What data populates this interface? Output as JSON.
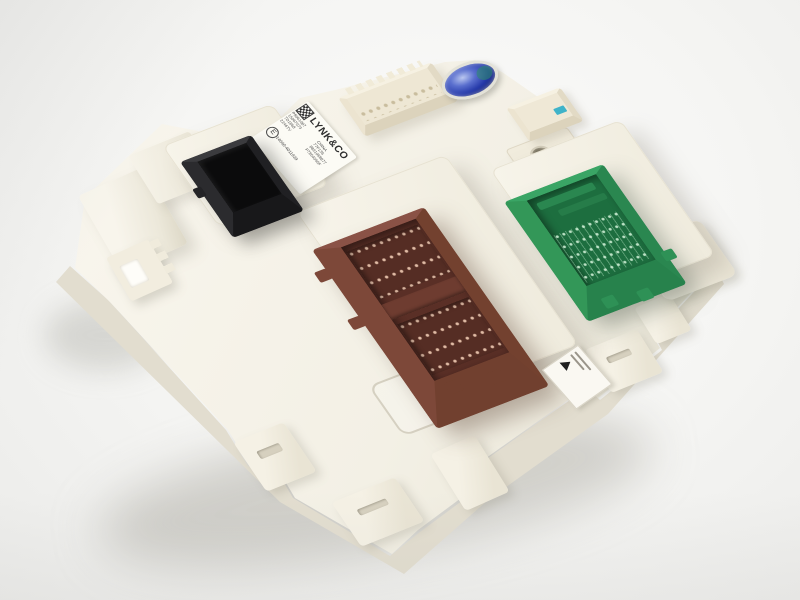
{
  "caption": "White automotive body control module photographed on a white background, with one black, one brown and one green connector socket, a blue vent seal and a LYNK&CO product label",
  "colors": {
    "background": "#f3f3f1",
    "module_body": "#f4f1e6",
    "black_connector": "#1c1c1e",
    "brown_connector": "#7a4637",
    "green_connector": "#2e9156",
    "blue_seal": "#2a3aa4",
    "label_background": "#fcfbf5"
  },
  "label": {
    "logo": "LYNK&CO",
    "part_lines": [
      "P8061087",
      "15067073",
      "7D1868",
      "2246TV"
    ],
    "info_lines": [
      "CHINA",
      "77F136",
      "8891068877",
      "P7854056F"
    ],
    "emark_letter": "E",
    "emark_number": "14640-4011939"
  }
}
